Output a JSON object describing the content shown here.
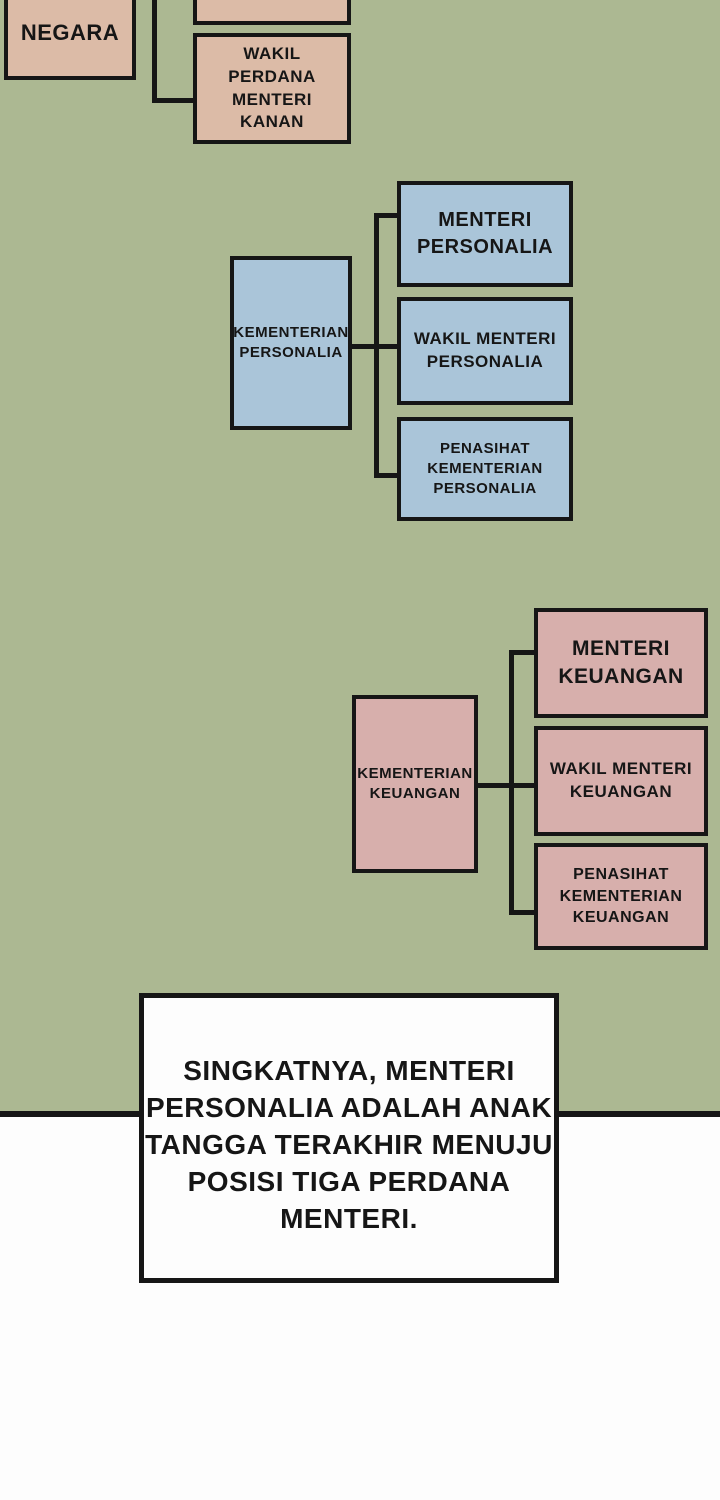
{
  "panel": {
    "background_color": "#acb892",
    "line_color": "#161616",
    "page_background": "#fdfdfd"
  },
  "org_chart": {
    "state_box": {
      "label": "NEGARA",
      "color": "#dcbba7"
    },
    "cropped_top_box": {
      "label": "",
      "color": "#dcbba7"
    },
    "deputy_pm_box": {
      "label": "WAKIL PERDANA MENTERI KANAN",
      "color": "#dcbba7"
    },
    "personalia_group": {
      "color": "#aac5d9",
      "parent_label": "KEMENTERIAN PERSONALIA",
      "children": [
        "MENTERI PERSONALIA",
        "WAKIL MENTERI PERSONALIA",
        "PENASIHAT KEMENTERIAN PERSONALIA"
      ]
    },
    "keuangan_group": {
      "color": "#d7afac",
      "parent_label": "KEMENTERIAN KEUANGAN",
      "children": [
        "MENTERI KEUANGAN",
        "WAKIL MENTERI KEUANGAN",
        "PENASIHAT KEMENTERIAN KEUANGAN"
      ]
    }
  },
  "caption": {
    "full_text": "SINGKATNYA, MENTERI PERSONALIA ADALAH ANAK TANGGA TERAKHIR MENUJU POSISI TIGA PERDANA MENTERI.",
    "lines": [
      "SINGKATNYA, MENTERI",
      "PERSONALIA ADALAH ANAK",
      "TANGGA TERAKHIR MENUJU",
      "POSISI TIGA PERDANA",
      "MENTERI."
    ]
  }
}
